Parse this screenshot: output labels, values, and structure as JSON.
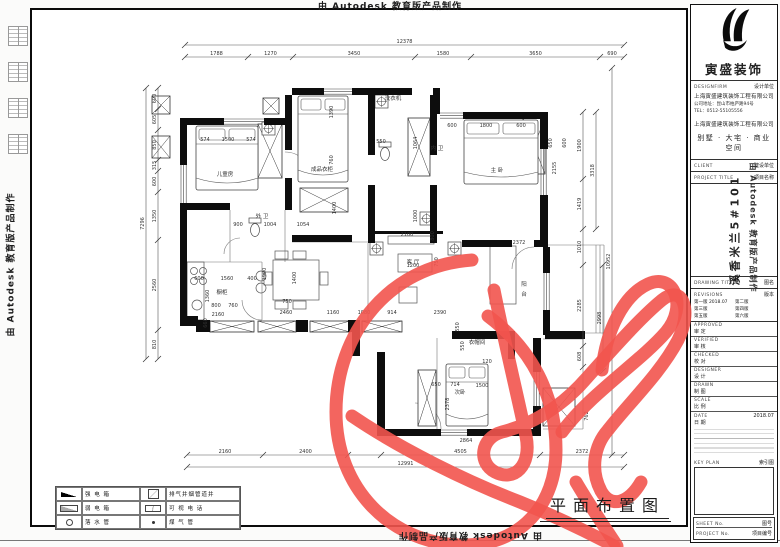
{
  "watermark": {
    "text": "由 Autodesk 教育版产品制作"
  },
  "drawing_title": {
    "text": "平面布置图"
  },
  "legend": {
    "items": [
      {
        "icon": "strong-power-box-symbol",
        "label": "强 电 箱"
      },
      {
        "icon": "vent-shaft-symbol",
        "label": "排气井烟管道井"
      },
      {
        "icon": "weak-power-box-symbol",
        "label": "弱 电 箱"
      },
      {
        "icon": "video-phone-symbol",
        "label": "可 视 电 话"
      },
      {
        "icon": "down-pipe-symbol",
        "label": "落 水 管"
      },
      {
        "icon": "gas-pipe-symbol",
        "label": "煤 气 管"
      }
    ]
  },
  "title_block": {
    "brand": "寅盛装饰",
    "design_firm_en": "DESIGNFIRM",
    "design_firm_cn": "设计单位",
    "company": "上海寅盛建筑装饰工程有限公司",
    "address": "公司地址：昆山市柏庐路94号",
    "tel": "TEL：0512-55105556",
    "company2": "上海寅盛建筑装饰工程有限公司",
    "tagline": "别墅 · 大宅 · 商业空间",
    "client_en": "CLIENT",
    "client_cn": "建设单位",
    "project_title_en": "PROJECT TITLE",
    "project_title_cn": "项目名称",
    "project_name": "溪香米兰5#101",
    "drawing_title_en": "DRAWING TITLE",
    "drawing_title_cn": "图名",
    "revisions_en": "REVISIONS",
    "revisions_cn": "版本",
    "revision_rows": [
      [
        "第一版",
        "2018.07",
        "第二版",
        ""
      ],
      [
        "第三版",
        "",
        "第四版",
        ""
      ],
      [
        "第五版",
        "",
        "第六版",
        ""
      ]
    ],
    "signoff_rows": [
      [
        "APPROVED",
        "审  定"
      ],
      [
        "VERIFIED",
        "审  核"
      ],
      [
        "CHECKED",
        "校  对"
      ],
      [
        "DESIGNER",
        "设  计"
      ],
      [
        "DRAWN",
        "制  图"
      ],
      [
        "SCALE",
        "比  例"
      ],
      [
        "DATE",
        "日  期"
      ]
    ],
    "date_value": "2018.07",
    "key_plan_en": "KEY PLAN",
    "key_plan_cn": "索引图",
    "sheet_en": "SHEET No.",
    "sheet_cn": "图号",
    "project_no_en": "PROJECT No.",
    "project_no_cn": "项目编号"
  },
  "plan": {
    "walls": [
      [
        180,
        118,
        44,
        7
      ],
      [
        264,
        118,
        28,
        7
      ],
      [
        180,
        125,
        7,
        40
      ],
      [
        180,
        203,
        7,
        62
      ],
      [
        180,
        261,
        7,
        60
      ],
      [
        180,
        316,
        18,
        10
      ],
      [
        292,
        88,
        32,
        7
      ],
      [
        352,
        88,
        60,
        7
      ],
      [
        285,
        95,
        7,
        55
      ],
      [
        285,
        178,
        7,
        32
      ],
      [
        368,
        95,
        7,
        60
      ],
      [
        368,
        185,
        7,
        58
      ],
      [
        430,
        95,
        7,
        60
      ],
      [
        430,
        185,
        7,
        58
      ],
      [
        433,
        88,
        7,
        26
      ],
      [
        463,
        112,
        77,
        7
      ],
      [
        540,
        112,
        8,
        37
      ],
      [
        540,
        195,
        8,
        48
      ],
      [
        462,
        240,
        50,
        7
      ],
      [
        534,
        240,
        14,
        7
      ],
      [
        292,
        235,
        60,
        7
      ],
      [
        180,
        203,
        50,
        7
      ],
      [
        543,
        247,
        7,
        26
      ],
      [
        543,
        310,
        7,
        25
      ],
      [
        196,
        320,
        14,
        12
      ],
      [
        296,
        320,
        12,
        12
      ],
      [
        348,
        320,
        10,
        12
      ],
      [
        352,
        320,
        8,
        36
      ],
      [
        377,
        352,
        8,
        84
      ],
      [
        452,
        331,
        62,
        8
      ],
      [
        508,
        331,
        7,
        28
      ],
      [
        377,
        429,
        64,
        7
      ],
      [
        467,
        429,
        72,
        7
      ],
      [
        533,
        338,
        8,
        34
      ],
      [
        533,
        406,
        8,
        30
      ],
      [
        545,
        331,
        40,
        8
      ],
      [
        373,
        231,
        70,
        3
      ]
    ],
    "hatch": [
      [
        258,
        124,
        24,
        54
      ],
      [
        300,
        188,
        48,
        24
      ],
      [
        408,
        118,
        22,
        58
      ],
      [
        523,
        118,
        22,
        56
      ],
      [
        152,
        96,
        18,
        18
      ],
      [
        152,
        136,
        18,
        22
      ],
      [
        263,
        98,
        16,
        16
      ],
      [
        313,
        98,
        20,
        12
      ],
      [
        210,
        321,
        44,
        11
      ],
      [
        258,
        321,
        38,
        11
      ],
      [
        310,
        321,
        40,
        11
      ],
      [
        362,
        321,
        40,
        11
      ],
      [
        418,
        370,
        18,
        56
      ],
      [
        543,
        388,
        32,
        38
      ]
    ],
    "windows": [
      {
        "x": 224,
        "y": 118,
        "l": 40,
        "o": "h"
      },
      {
        "x": 322,
        "y": 88,
        "l": 30,
        "o": "h"
      },
      {
        "x": 440,
        "y": 112,
        "l": 23,
        "o": "h"
      },
      {
        "x": 180,
        "y": 165,
        "l": 38,
        "o": "v"
      },
      {
        "x": 540,
        "y": 149,
        "l": 46,
        "o": "v"
      },
      {
        "x": 543,
        "y": 273,
        "l": 37,
        "o": "v"
      },
      {
        "x": 533,
        "y": 372,
        "l": 34,
        "o": "v"
      },
      {
        "x": 441,
        "y": 429,
        "l": 26,
        "o": "h"
      }
    ],
    "lines": [
      [
        548,
        245,
        604,
        245
      ],
      [
        604,
        245,
        604,
        333
      ],
      [
        548,
        333,
        604,
        333
      ],
      [
        600,
        245,
        600,
        333
      ],
      [
        596,
        245,
        596,
        333
      ],
      [
        230,
        210,
        230,
        262
      ],
      [
        285,
        210,
        285,
        262
      ],
      [
        180,
        262,
        262,
        262
      ],
      [
        262,
        262,
        262,
        320
      ],
      [
        187,
        262,
        187,
        320
      ],
      [
        437,
        338,
        437,
        429
      ],
      [
        543,
        339,
        583,
        339
      ],
      [
        583,
        339,
        583,
        429
      ],
      [
        543,
        429,
        583,
        429
      ],
      [
        292,
        242,
        368,
        242
      ],
      [
        368,
        243,
        368,
        320
      ]
    ],
    "arcs": [
      "M285,152 A26,26 0 0 1 311,178",
      "M534,247 A22,22 0 0 0 512,269",
      "M441,429 A26,26 0 0 0 415,403",
      "M240,238 A16,16 0 0 0 224,254",
      "M262,320 A20,20 0 0 1 242,300"
    ],
    "beds": [
      [
        196,
        126,
        62,
        64
      ],
      [
        298,
        96,
        50,
        86
      ],
      [
        464,
        120,
        74,
        64
      ],
      [
        446,
        364,
        42,
        62
      ]
    ],
    "thinrects": [
      [
        187,
        262,
        17,
        58
      ],
      [
        273,
        260,
        46,
        40
      ],
      [
        388,
        236,
        46,
        8
      ],
      [
        398,
        254,
        34,
        18
      ],
      [
        490,
        246,
        26,
        58
      ],
      [
        399,
        287,
        18,
        16
      ],
      [
        275,
        251,
        13,
        8
      ],
      [
        293,
        251,
        13,
        8
      ],
      [
        275,
        301,
        13,
        8
      ],
      [
        293,
        301,
        13,
        8
      ],
      [
        264,
        272,
        8,
        13
      ],
      [
        320,
        272,
        8,
        13
      ],
      [
        549,
        392,
        20,
        30
      ]
    ],
    "circles": [
      [
        194,
        271,
        3.5
      ],
      [
        203,
        271,
        3.5
      ],
      [
        194,
        281,
        3.5
      ],
      [
        203,
        281,
        3.5
      ],
      [
        197,
        305,
        5
      ],
      [
        261,
        276,
        5
      ],
      [
        261,
        288,
        5
      ]
    ],
    "fixtures": [
      [
        262,
        122
      ],
      [
        370,
        242
      ],
      [
        448,
        242
      ],
      [
        375,
        95
      ],
      [
        420,
        212
      ]
    ],
    "toilets": [
      [
        255,
        228
      ],
      [
        385,
        152
      ]
    ],
    "chains": [
      {
        "o": "h",
        "pos": 57,
        "cuts": [
          185,
          248,
          293,
          415,
          471,
          600,
          624
        ],
        "labels": [
          "1788",
          "1270",
          "3450",
          "1580",
          "3650",
          "690"
        ]
      },
      {
        "o": "h",
        "pos": 45,
        "cuts": [
          185,
          624
        ],
        "labels": [
          "12378"
        ]
      },
      {
        "o": "h",
        "pos": 455,
        "cuts": [
          187,
          263,
          348,
          381,
          540,
          624
        ],
        "labels": [
          "2160",
          "2400",
          "",
          "4505",
          "2372"
        ]
      },
      {
        "o": "h",
        "pos": 467,
        "cuts": [
          187,
          624
        ],
        "labels": [
          "12991"
        ]
      },
      {
        "o": "v",
        "pos": 158,
        "cuts": [
          88,
          109,
          130,
          160,
          171,
          192,
          240,
          330,
          359
        ],
        "labels": [
          "600",
          "605",
          "850",
          "315",
          "600",
          "1350",
          "2560",
          "810"
        ]
      },
      {
        "o": "v",
        "pos": 146,
        "cuts": [
          88,
          359
        ],
        "labels": [
          "7296"
        ]
      },
      {
        "o": "v",
        "pos": 583,
        "cuts": [
          112,
          179,
          229,
          265,
          346,
          367
        ],
        "labels": [
          "1900",
          "1419",
          "1010",
          "2285",
          "608"
        ]
      },
      {
        "o": "v",
        "pos": 596,
        "cuts": [
          112,
          229
        ],
        "labels": [
          "3318"
        ]
      },
      {
        "o": "v",
        "pos": 603,
        "cuts": [
          265,
          371
        ],
        "labels": [
          "2998"
        ]
      },
      {
        "o": "v",
        "pos": 612,
        "cuts": [
          68,
          455
        ],
        "labels": [
          "10952"
        ]
      }
    ],
    "dims": [
      [
        "574",
        205,
        141,
        0
      ],
      [
        "1500",
        228,
        141,
        0
      ],
      [
        "574",
        251,
        141,
        0
      ],
      [
        "1390",
        333,
        112,
        1
      ],
      [
        "760",
        333,
        160,
        1
      ],
      [
        "900",
        238,
        226,
        0
      ],
      [
        "1004",
        270,
        226,
        0
      ],
      [
        "1054",
        303,
        226,
        0
      ],
      [
        "1400",
        336,
        208,
        1
      ],
      [
        "550",
        381,
        143,
        0
      ],
      [
        "1064",
        417,
        143,
        1
      ],
      [
        "1000",
        417,
        216,
        1
      ],
      [
        "600",
        452,
        127,
        0
      ],
      [
        "1800",
        486,
        127,
        0
      ],
      [
        "600",
        521,
        127,
        0
      ],
      [
        "650",
        552,
        143,
        1
      ],
      [
        "600",
        566,
        143,
        1
      ],
      [
        "2155",
        556,
        168,
        1
      ],
      [
        "2100",
        407,
        236,
        0
      ],
      [
        "800",
        434,
        236,
        1
      ],
      [
        "1200",
        413,
        267,
        0
      ],
      [
        "750",
        438,
        262,
        1
      ],
      [
        "2372",
        519,
        244,
        0
      ],
      [
        "600",
        199,
        280,
        0
      ],
      [
        "1560",
        227,
        280,
        0
      ],
      [
        "400",
        252,
        280,
        0
      ],
      [
        "1900",
        266,
        274,
        1
      ],
      [
        "1360",
        209,
        296,
        1
      ],
      [
        "800",
        216,
        307,
        0
      ],
      [
        "760",
        233,
        307,
        0
      ],
      [
        "2160",
        218,
        316,
        0
      ],
      [
        "660",
        207,
        323,
        1
      ],
      [
        "1400",
        296,
        278,
        1
      ],
      [
        "750",
        287,
        303,
        0
      ],
      [
        "2460",
        286,
        314,
        0
      ],
      [
        "1160",
        333,
        314,
        0
      ],
      [
        "1080",
        364,
        314,
        0
      ],
      [
        "914",
        392,
        314,
        0
      ],
      [
        "2390",
        440,
        314,
        0
      ],
      [
        "550",
        459,
        327,
        1
      ],
      [
        "650",
        436,
        386,
        0
      ],
      [
        "714",
        455,
        386,
        0
      ],
      [
        "2378",
        449,
        404,
        1
      ],
      [
        "1500",
        482,
        387,
        0
      ],
      [
        "550",
        464,
        346,
        1
      ],
      [
        "120",
        487,
        363,
        0
      ],
      [
        "762",
        588,
        416,
        1
      ],
      [
        "2864",
        466,
        442,
        0
      ]
    ],
    "labels": [
      [
        "儿童房",
        225,
        176
      ],
      [
        "外 卫",
        262,
        218
      ],
      [
        "内 卫",
        437,
        150
      ],
      [
        "成品衣柜",
        322,
        171
      ],
      [
        "主 卧",
        497,
        172
      ],
      [
        "客 厅",
        413,
        264
      ],
      [
        "阳",
        524,
        286
      ],
      [
        "台",
        524,
        296
      ],
      [
        "橱柜",
        222,
        294
      ],
      [
        "洗衣机",
        393,
        100
      ],
      [
        "次卧",
        460,
        394
      ],
      [
        "衣帽间",
        477,
        344
      ]
    ]
  },
  "scribble": {
    "color": "#f2544e",
    "width": 13,
    "paths": [
      "M472,260 C388,266 336,334 336,412 C336,490 392,543 460,545 C522,547 556,503 556,450 C556,396 532,349 488,316",
      "M352,416 C402,450 468,482 520,502 C552,515 584,530 614,546",
      "M494,290 C504,340 518,398 526,436 C532,466 514,482 495,472 C478,463 480,438 502,432 C530,425 560,408 584,381 C612,350 640,318 662,300 C684,283 692,312 678,340 C660,374 628,404 608,430 C594,446 590,470 601,491 C611,509 629,503 641,482",
      "M562,432 C590,394 640,362 666,332 C688,306 674,272 648,284 C624,295 606,330 602,370",
      "M576,482 C590,506 604,526 617,546"
    ]
  }
}
